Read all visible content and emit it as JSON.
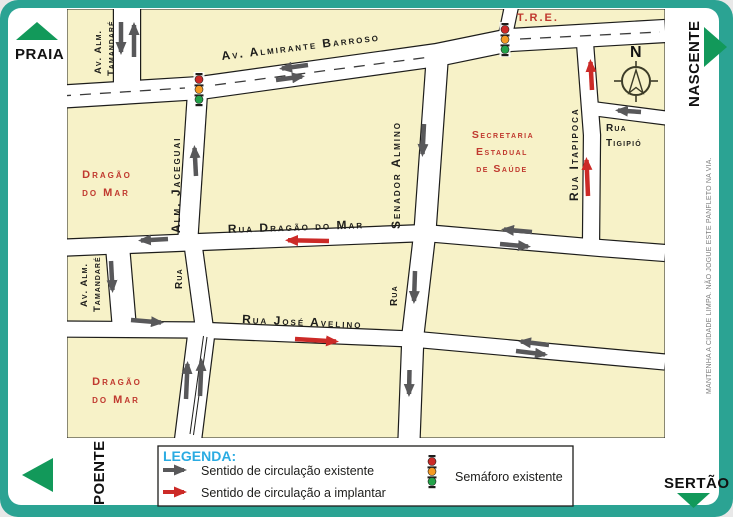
{
  "colors": {
    "frame_teal": "#2ba393",
    "block_cream": "#f7f2c8",
    "street_white": "#ffffff",
    "outline_black": "#1d1d1b",
    "existing_arrow_gray": "#58585a",
    "implant_arrow_red": "#cc2a27",
    "building_label_red": "#c0392f",
    "legend_title_cyan": "#2aabe2",
    "direction_green": "#12995a"
  },
  "directions": {
    "top_left": "PRAIA",
    "top_right": "NASCENTE",
    "bottom_left": "POENTE",
    "bottom_right": "SERTÃO"
  },
  "compass": {
    "north_label": "N"
  },
  "streets": {
    "barroso": "Av. Almirante Barroso",
    "dragao_do_mar": "Rua Dragão do Mar",
    "jose_avelino": "Rua José Avelino",
    "jaceguai": "Alm. Jaceguai",
    "jaceguai_lower": "Rua",
    "senador_almino": "Senador Almino",
    "senador_almino_lower": "Rua",
    "itapipoca": "Rua Itapipoca",
    "tigipio_line1": "Rua",
    "tigipio_line2": "Tigipió",
    "tamandare_line1": "Av. Alm.",
    "tamandare_line2": "Tamandaré",
    "tre": "T.R.E."
  },
  "places": {
    "dragao_norte_line1": "Dragão",
    "dragao_norte_line2": "do Mar",
    "dragao_sul_line1": "Dragão",
    "dragao_sul_line2": "do Mar",
    "secretaria_line1": "Secretaria",
    "secretaria_line2": "Estadual",
    "secretaria_line3": "de Saúde"
  },
  "legend": {
    "title": "LEGENDA:",
    "items": [
      {
        "symbol": "existing-arrow-icon",
        "label": "Sentido de circulação existente"
      },
      {
        "symbol": "implant-arrow-icon",
        "label": "Sentido de circulação a implantar"
      },
      {
        "symbol": "traffic-light-icon",
        "label": "Semáforo existente"
      }
    ]
  },
  "margin_note": "MANTENHA A CIDADE LIMPA. NÃO JOGUE ESTE PANFLETO NA VIA."
}
